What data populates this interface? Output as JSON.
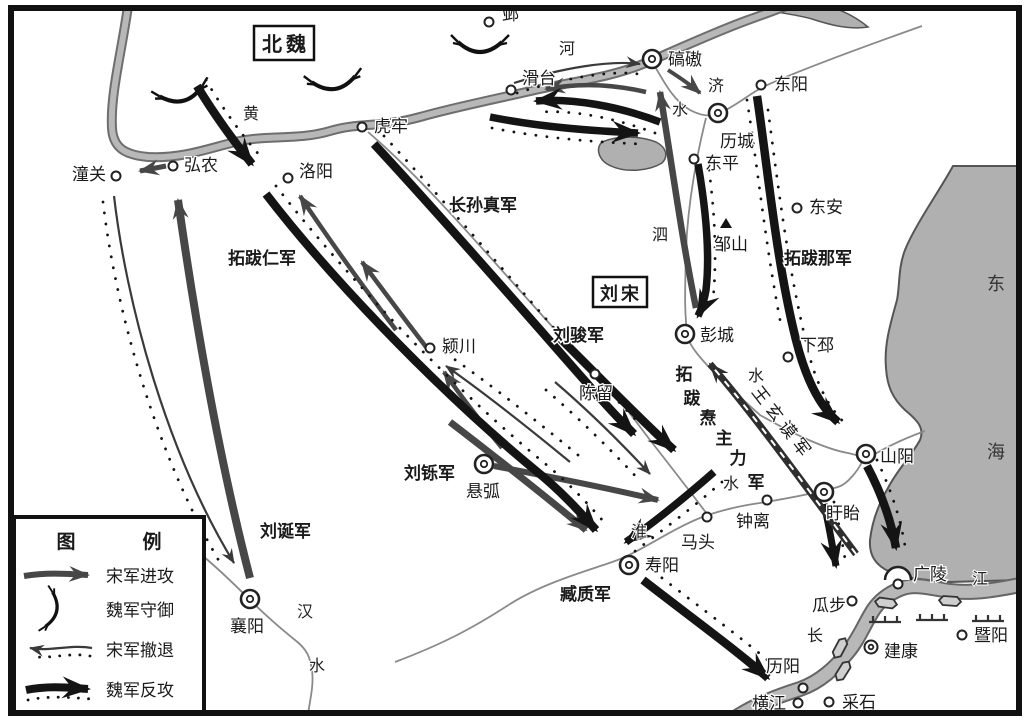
{
  "regions": {
    "north_wei": "北魏",
    "liu_song": "刘宋",
    "east_sea_chars": [
      "东",
      "海"
    ]
  },
  "rivers": {
    "huanghe": [
      "黄",
      "河"
    ],
    "jishui": [
      "济",
      "水"
    ],
    "sishui": [
      "泗",
      "水"
    ],
    "huaishui": [
      "淮",
      "水"
    ],
    "hanshui": [
      "汉",
      "水"
    ],
    "changjiang": [
      "长",
      "江"
    ]
  },
  "cities": {
    "tongguan": "潼关",
    "hongnong": "弘农",
    "luoyang": "洛阳",
    "hulao": "虎牢",
    "huatai": "滑台",
    "ye": "邺",
    "qiaoao": "碻磝",
    "dongyang": "东阳",
    "licheng": "历城",
    "dongping": "东平",
    "dongan": "东安",
    "zoushan": "邹山",
    "xiapi": "下邳",
    "pengcheng": "彭城",
    "yingchuan": "颍川",
    "chenliu": "陈留",
    "shanyang": "山阳",
    "xuyi": "盱眙",
    "zhongli": "钟离",
    "matou": "马头",
    "shouyang": "寿阳",
    "xuanhu": "悬弧",
    "xiangyang": "襄阳",
    "guangling": "广陵",
    "guabu": "瓜步",
    "jiankang": "建康",
    "jiyang": "暨阳",
    "liyang": "历阳",
    "hengjiang": "横江",
    "caishi": "采石"
  },
  "armies": {
    "liu_jun": "刘骏军",
    "liu_shuo": "刘铄军",
    "liu_dan": "刘诞军",
    "zang_zhi": "臧质军",
    "changsun_zhen": "长孙真军",
    "tuoba_ren": "拓跋仁军",
    "tuoba_na": "拓跋那军",
    "wang_xuanmo": "王玄谟军",
    "tuoba_tao": "拓跋焘主力军",
    "tuoba_tao_chars": [
      "拓",
      "跋",
      "焘",
      "主",
      "力",
      "军"
    ]
  },
  "legend": {
    "title_chars": [
      "图",
      "例"
    ],
    "items": [
      {
        "key": "song-attack",
        "label": "宋军进攻"
      },
      {
        "key": "wei-defense",
        "label": "魏军守御"
      },
      {
        "key": "song-retreat",
        "label": "宋军撤退"
      },
      {
        "key": "wei-counter",
        "label": "魏军反攻"
      }
    ]
  },
  "colors": {
    "river_fill": "#b8b8b8",
    "river_edge": "#6e6e6e",
    "sea_fill": "#b0b0b0",
    "song_arrow": "#474747",
    "wei_arrow": "#141414"
  }
}
